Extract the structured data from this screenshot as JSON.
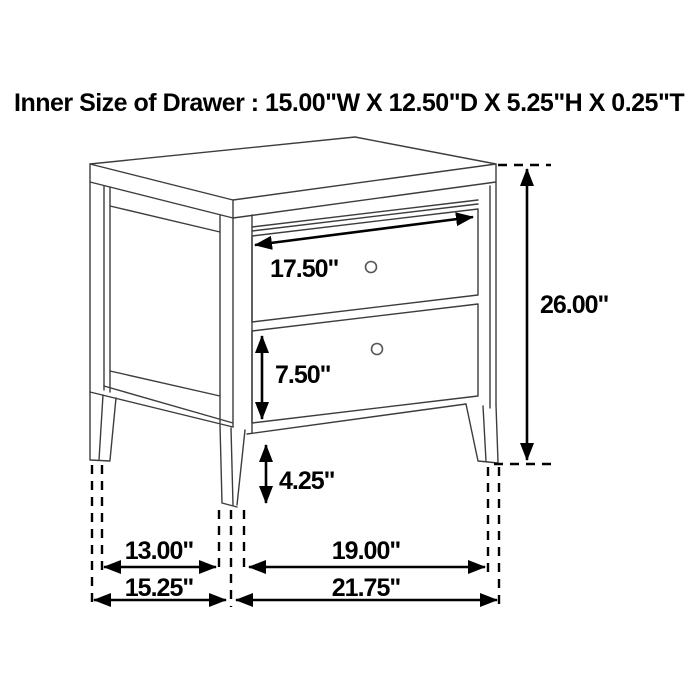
{
  "title": "Inner Size of Drawer : 15.00\"W X 12.50\"D X 5.25\"H X 0.25\"T",
  "diagram": {
    "item": "two-drawer nightstand dimension line drawing",
    "background_color": "#ffffff",
    "line_color": "#3d3d3d",
    "annotation_color": "#000000",
    "units": "inches",
    "dimensions": {
      "drawer_width": "17.50\"",
      "overall_height": "26.00\"",
      "lower_drawer_height": "7.50\"",
      "leg_height": "4.25\"",
      "side_inner_depth": "13.00\"",
      "side_overall_depth": "15.25\"",
      "front_inner_width": "19.00\"",
      "front_overall_width": "21.75\""
    }
  }
}
